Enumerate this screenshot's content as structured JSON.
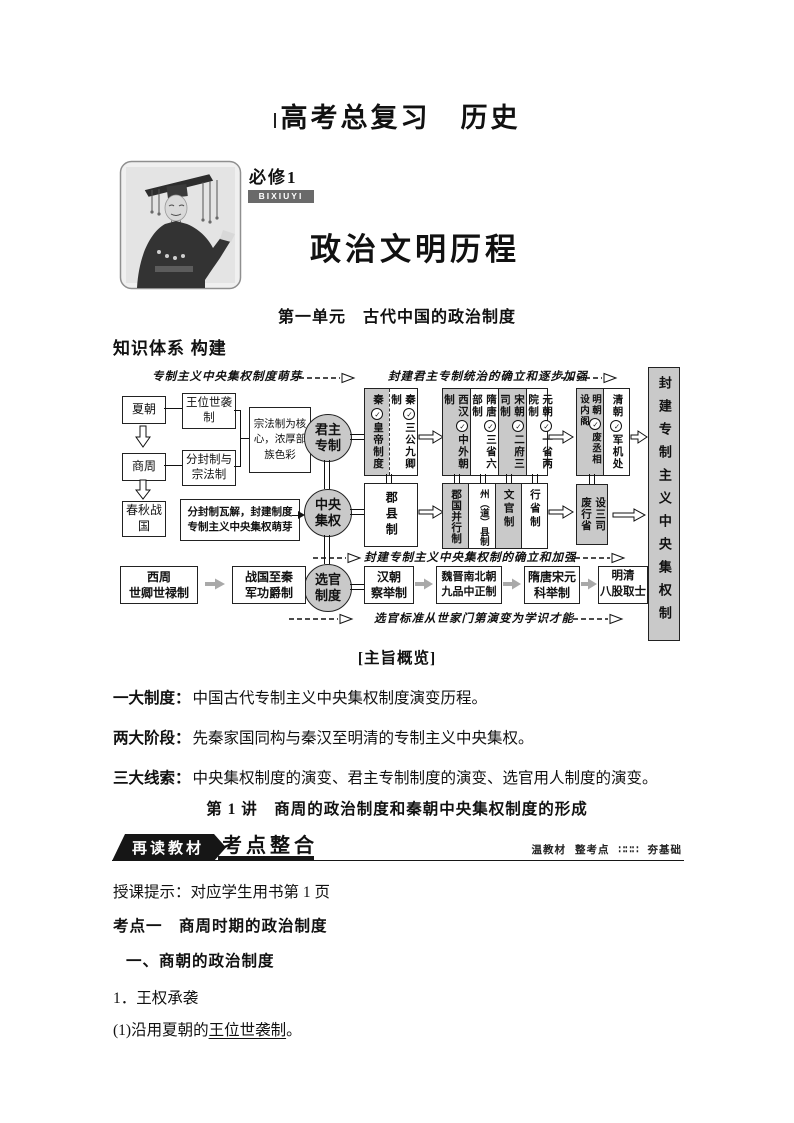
{
  "header": {
    "title": "高考总复习　历史"
  },
  "cover": {
    "module_label": "必修1",
    "module_badge": "BIXIUYI",
    "main_title": "政治文明历程",
    "unit_title": "第一单元　古代中国的政治制度",
    "knowledge_heading": "知识体系 构建"
  },
  "diagram": {
    "icons": {
      "check": "✓"
    },
    "annotations": {
      "top_left": "专制主义中央集权制度萌芽",
      "top_right": "封建君主专制统治的确立和逐步加强",
      "middle": "封建专制主义中央集权制的确立和加强",
      "bottom": "选官标准从世家门第演变为学识才能"
    },
    "left_chain": {
      "xia": "夏朝",
      "hereditary": "王位世袭制",
      "shangzhou": "商周",
      "fengjian_zongfa": "分封制与宗法制",
      "zongfa_note": "宗法制为核心，浓厚部族色彩",
      "chunqiu": "春秋战国",
      "collapse_note": "分封制瓦解，封建制度专制主义中央集权萌芽"
    },
    "circles": {
      "monarchy": "君主专制",
      "central": "中央集权",
      "selection": "选官制度"
    },
    "monarchy_row": {
      "qin": [
        {
          "era": "秦",
          "label": "皇帝制度"
        },
        {
          "era": "秦",
          "label": "三公九卿制"
        }
      ],
      "han_yuan": [
        {
          "era": "西汉",
          "label": "中外朝制"
        },
        {
          "era": "隋唐",
          "label": "三省六部制"
        },
        {
          "era": "宋朝",
          "label": "二府三司制"
        },
        {
          "era": "元朝",
          "label": "一省两院制"
        }
      ],
      "ming_qing": [
        {
          "era": "明朝",
          "label": "废丞相设内阁"
        },
        {
          "era": "清朝",
          "label": "军机处"
        }
      ]
    },
    "central_row": {
      "junxianzhi": "郡县制",
      "systems": [
        "郡国并行制",
        "州（道）县制",
        "文官制",
        "行省制"
      ],
      "ming_reform": [
        "设三司",
        "废行省"
      ]
    },
    "selection_row": [
      {
        "era": "西周",
        "label": "世卿世禄制"
      },
      {
        "era": "战国至秦",
        "label": "军功爵制"
      },
      {
        "era": "汉朝",
        "label": "察举制"
      },
      {
        "era": "魏晋南北朝",
        "label": "九品中正制"
      },
      {
        "era": "隋唐宋元",
        "label": "科举制"
      },
      {
        "era": "明清",
        "label": "八股取士"
      }
    ],
    "result_box": "封建专制主义中央集权制"
  },
  "overview": {
    "title": "[主旨概览]",
    "items": [
      {
        "label": "一大制度：",
        "text": "中国古代专制主义中央集权制度演变历程。"
      },
      {
        "label": "两大阶段：",
        "text": "先秦家国同构与秦汉至明清的专制主义中央集权。"
      },
      {
        "label": "三大线索：",
        "text": "中央集权制度的演变、君主专制制度的演变、选官用人制度的演变。"
      }
    ],
    "lecture_title": "第 1 讲　商周的政治制度和秦朝中央集权制度的形成"
  },
  "section": {
    "ribbon": "再读教材",
    "tab": "考点整合",
    "note_a": "温教材",
    "note_b": "整考点",
    "note_dots": "∷∷∷",
    "note_c": "夯基础",
    "tip": "授课提示：对应学生用书第 1 页",
    "point_heading": "考点一　商周时期的政治制度",
    "sub_heading": "一、商朝的政治制度",
    "item_no": "1．王权承袭",
    "item_prefix": "(1)沿用夏朝的",
    "item_term": "王位世袭制",
    "item_suffix": "。"
  }
}
